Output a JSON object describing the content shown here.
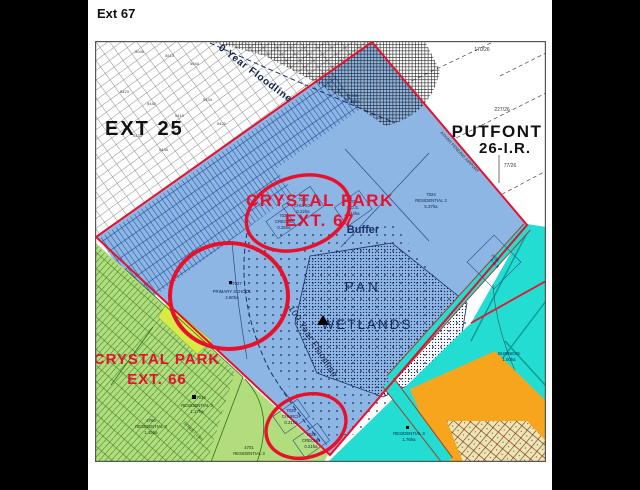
{
  "title": "Ext 67",
  "regions": {
    "ext25": "EXT 25",
    "putfont1": "PUTFONT",
    "putfont2": "26-I.R.",
    "crystal67_1": "CRYSTAL PARK",
    "crystal67_2": "EXT. 67",
    "crystal66_1": "CRYSTAL PARK",
    "crystal66_2": "EXT. 66",
    "pan": "PAN",
    "wetlands": "WETLANDS",
    "buffer": "Buffer"
  },
  "floodlines": {
    "top": "0 Year Floodline",
    "middle": "100 Year Floodline"
  },
  "notes": {
    "airport": "ATKINS PENDING AIRPORT",
    "street": "STREET 13m"
  },
  "putfont_parcels": {
    "p1": "170/26",
    "p2": "227/26",
    "p3": "77/26"
  },
  "ext25_numbers": [
    "5045",
    "5513",
    "5644",
    "5423",
    "5440",
    "5419",
    "5433",
    "5438",
    "5434",
    "5422"
  ],
  "parcels": {
    "church_n": {
      "num": "7028",
      "use": "CHURCH",
      "area": "0.22ha"
    },
    "creche_n": {
      "num": "7026",
      "use": "CRECHE",
      "area": "0.25ha"
    },
    "pos_mid": {
      "num": "7031",
      "use": "P.O.S.",
      "area": "0.44ha"
    },
    "pos_top": {
      "use": "P.O.S.",
      "area": "2.45ha"
    },
    "res_main": {
      "num": "7024",
      "use": "RESIDENTIAL 3",
      "area": "5.37ha"
    },
    "school": {
      "num": "7027",
      "use": "PRIMARY SCHOOL",
      "area": "2.80ha"
    },
    "church_s": {
      "num": "7025",
      "use": "CHURCH",
      "area": "0.21ha"
    },
    "creche_s": {
      "num": "7023",
      "use": "CRECHE",
      "area": "0.21ha"
    },
    "pos_diamond": {
      "num": "7035",
      "use": "P.O.S."
    },
    "res_66a": {
      "num": "7016",
      "use": "RESIDENTIAL 3",
      "area": "1.17ha"
    },
    "res_66b": {
      "num": "4766",
      "use": "RESIDENTIAL 3",
      "area": "1.15ha"
    },
    "res_66c": {
      "num": "4701",
      "use": "RESIDENTIAL 3"
    },
    "res_orange": {
      "use": "RESIDENTIAL 3",
      "area": "1.76ha"
    },
    "business": {
      "use": "BUSINESS",
      "area": "1.00ha"
    }
  },
  "colors": {
    "ext67_fill": "#8db6e4",
    "ext66_fill": "#b2dd7c",
    "boundary_red": "#e8102c",
    "road_teal": "#23dcd2",
    "residential_orange": "#f6a51c",
    "wetland_navy": "#16306a"
  }
}
